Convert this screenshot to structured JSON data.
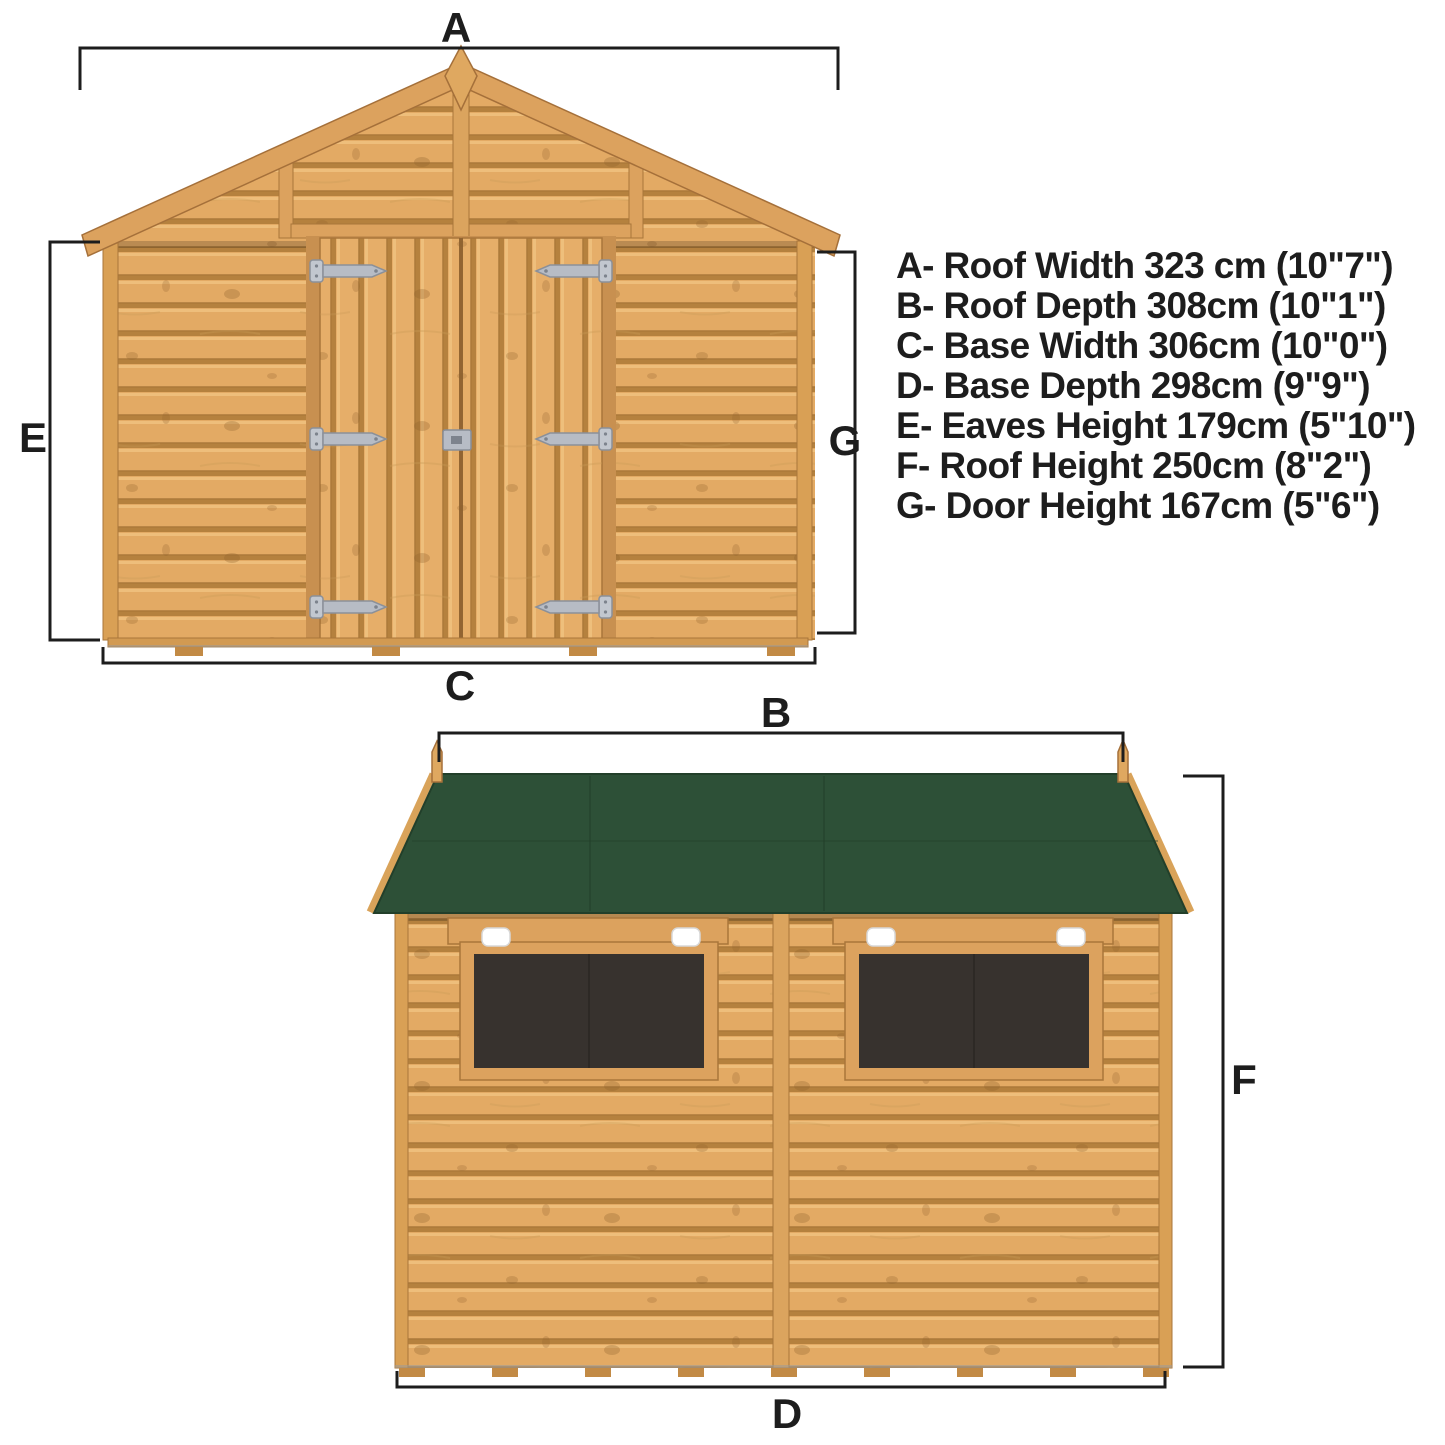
{
  "diagram": {
    "type": "shed-dimension-diagram",
    "front_view": {
      "label_roof_width": "A",
      "label_eaves_height": "E",
      "label_door_height": "G",
      "label_base_width": "C"
    },
    "side_view": {
      "label_roof_depth": "B",
      "label_base_depth": "D",
      "label_roof_height": "F"
    },
    "legend": {
      "lines": [
        "A- Roof Width 323 cm (10\"7\")",
        "B- Roof Depth 308cm (10\"1\")",
        "C- Base Width 306cm (10\"0\")",
        "D- Base Depth 298cm (9\"9\")",
        "E- Eaves Height 179cm (5\"10\")",
        "F- Roof Height 250cm (8\"2\")",
        "G- Door Height 167cm (5\"6\")"
      ]
    },
    "colors": {
      "wood": "#e3aa64",
      "wood_shadow": "#b5813e",
      "wood_trim": "#dca25e",
      "roof_felt_green": "#2d5037",
      "window_glass": "#37322e",
      "hinge_metal": "#b7bcc5",
      "dimension_line": "#1d1d1d",
      "background": "#ffffff"
    }
  }
}
